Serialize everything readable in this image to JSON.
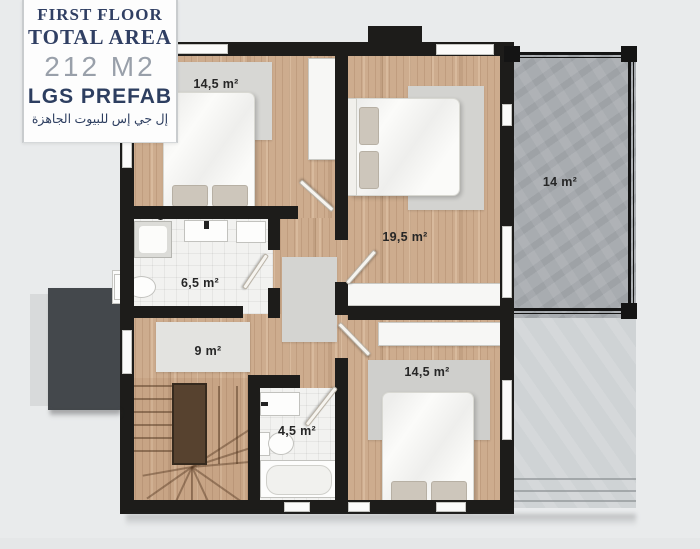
{
  "panel": {
    "floor_title": "FIRST FLOOR",
    "area_title": "TOTAL AREA",
    "area_value": "212 M2",
    "brand": "LGS PREFAB",
    "brand_arabic": "إل جي إس للبيوت الجاهزة"
  },
  "rooms": {
    "bedroom_top_left": {
      "area": "14,5 m²"
    },
    "bedroom_middle": {
      "area": "19,5 m²"
    },
    "balcony": {
      "area": "14 m²"
    },
    "bathroom_main": {
      "area": "6,5 m²"
    },
    "hallway": {
      "area": "9 m²"
    },
    "bathroom_small": {
      "area": "4,5 m²"
    },
    "bedroom_bottom": {
      "area": "14,5 m²"
    }
  },
  "colors": {
    "background": "#e9ebec",
    "wall": "#1d1c1a",
    "wood_floor": "#cdac8e",
    "tile_floor": "#f2f2f0",
    "balcony_floor": "#a8acb0",
    "terrace_floor": "#cfd3d5",
    "canopy_dark": "#44484c",
    "stair_wall_brown": "#57422f",
    "brand_navy": "#2d3e60",
    "area_value_gray": "#99a0aa",
    "room_label_dark": "#262626"
  }
}
